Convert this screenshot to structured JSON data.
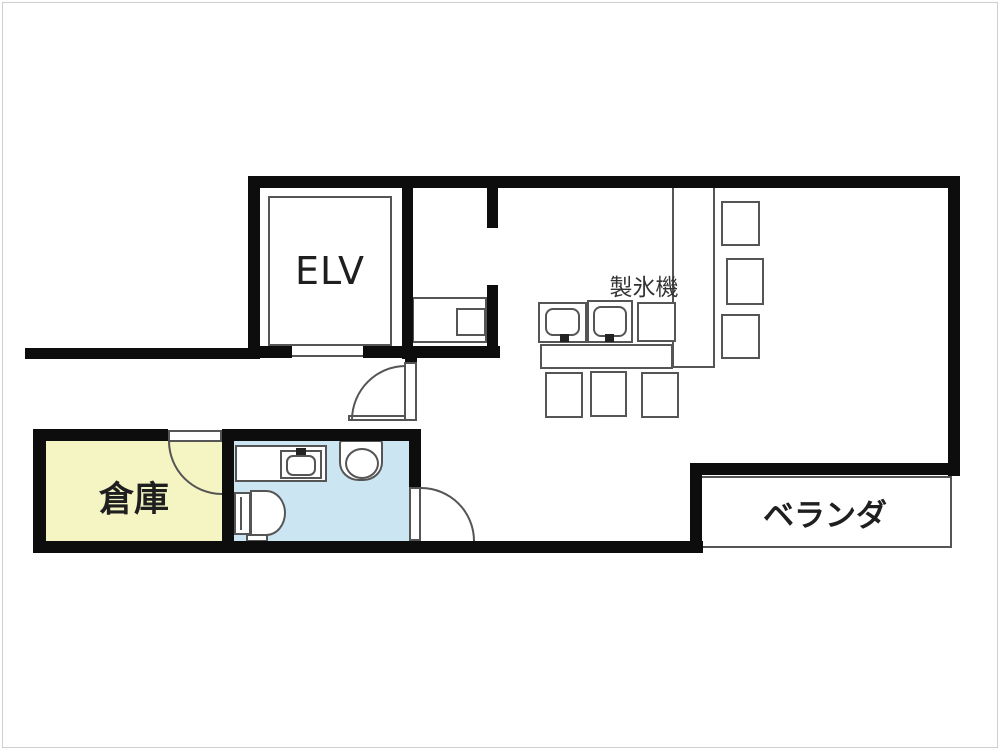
{
  "plan": {
    "rooms": {
      "elevator": "ELV",
      "storage": "倉庫",
      "veranda": "ベランダ"
    },
    "equipment": {
      "ice_maker": "製氷機"
    },
    "colors": {
      "wall": "#0d0d0d",
      "line": "#555555",
      "storage_fill": "#f5f5c4",
      "bathroom_fill": "#cbe5f3",
      "text": "#1f1f1f"
    }
  }
}
